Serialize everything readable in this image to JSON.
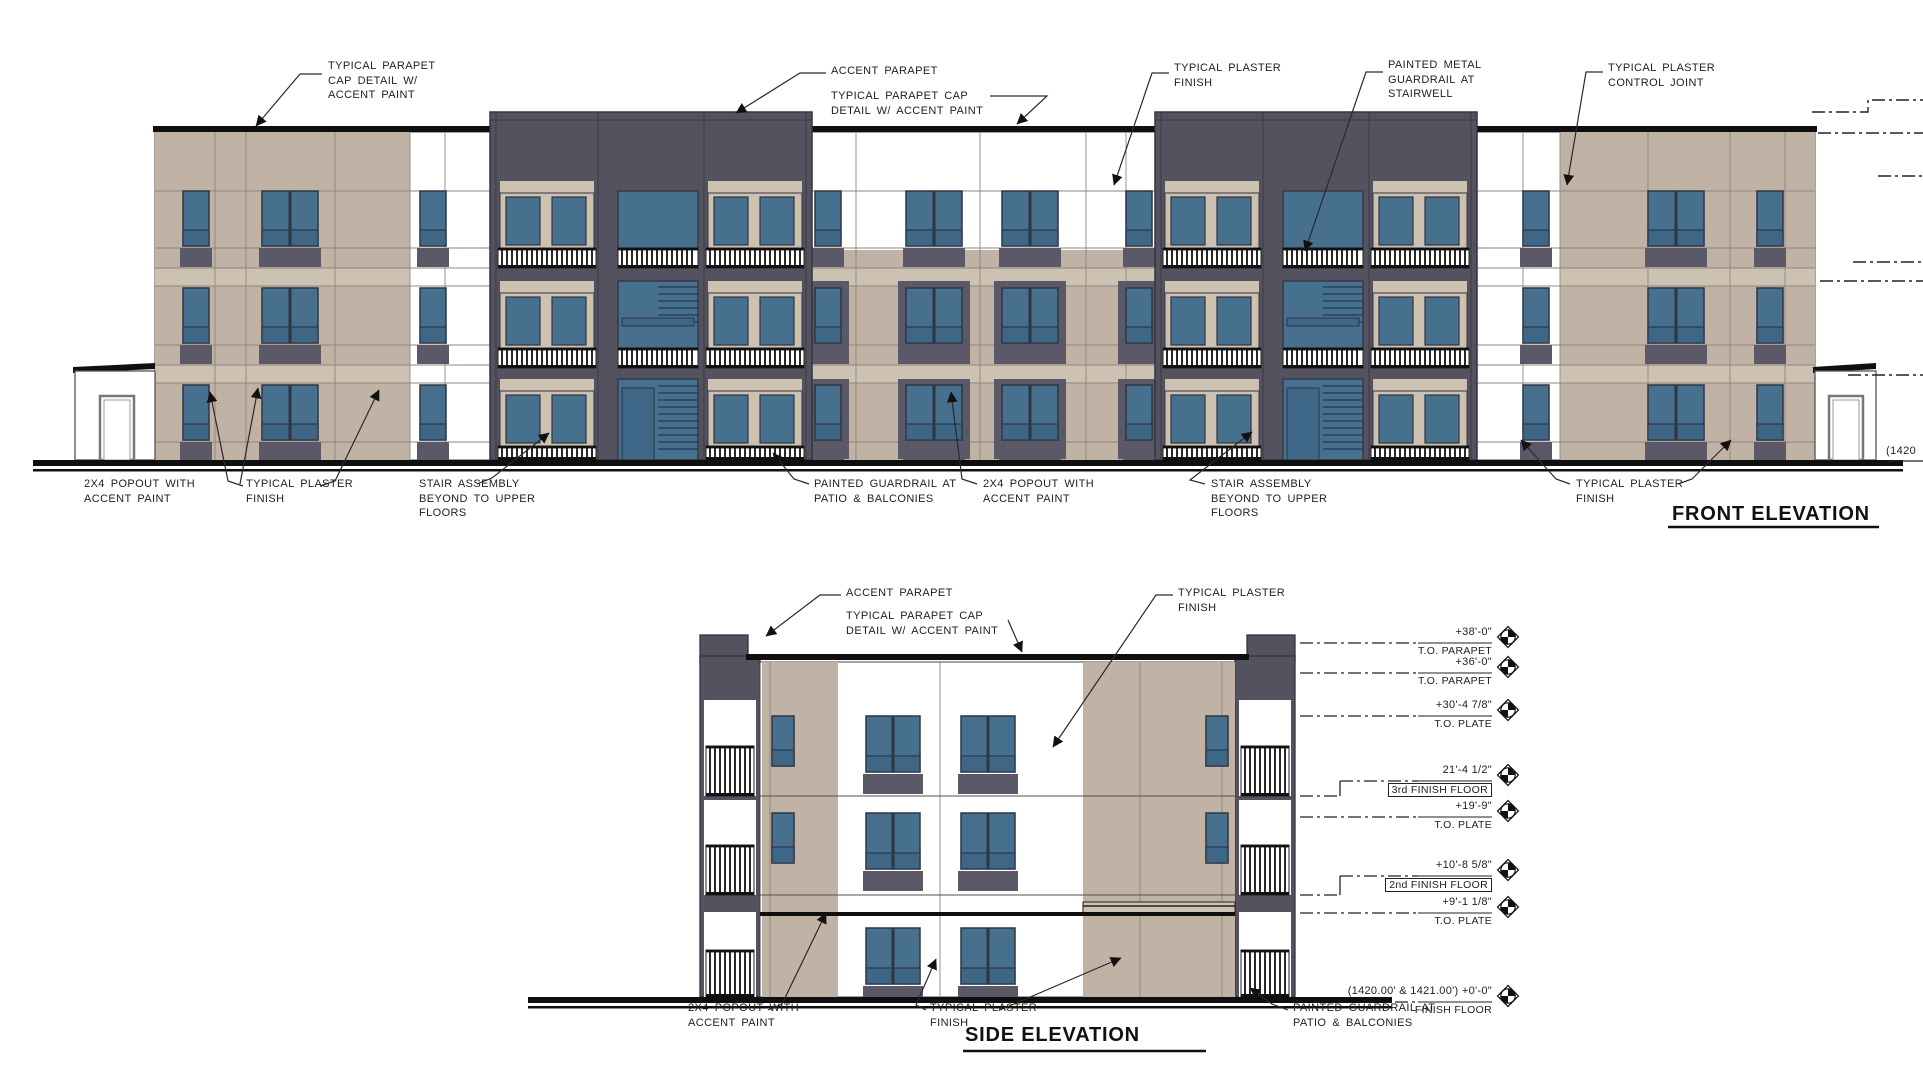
{
  "sheet": {
    "type_note": "architectural elevation drawing"
  },
  "front_elevation": {
    "title": "FRONT ELEVATION",
    "callouts": {
      "parapet_cap_left": "TYPICAL PARAPET\nCAP DETAIL W/\nACCENT PAINT",
      "accent_parapet": "ACCENT PARAPET",
      "parapet_cap_mid": "TYPICAL PARAPET CAP\nDETAIL W/ ACCENT PAINT",
      "plaster_finish_top": "TYPICAL PLASTER\nFINISH",
      "metal_guardrail": "PAINTED METAL\nGUARDRAIL AT\nSTAIRWELL",
      "control_joint": "TYPICAL PLASTER\nCONTROL JOINT",
      "popout_left": "2X4 POPOUT WITH\nACCENT PAINT",
      "plaster_finish_bottom_left": "TYPICAL PLASTER\nFINISH",
      "stair_assembly_left": "STAIR ASSEMBLY\nBEYOND TO UPPER\nFLOORS",
      "guardrail_patio": "PAINTED GUARDRAIL AT\nPATIO & BALCONIES",
      "popout_mid": "2X4 POPOUT WITH\nACCENT PAINT",
      "stair_assembly_right": "STAIR ASSEMBLY\nBEYOND TO UPPER\nFLOORS",
      "plaster_finish_bottom_right": "TYPICAL PLASTER\nFINISH",
      "partial_right_note": "(1420"
    }
  },
  "side_elevation": {
    "title": "SIDE ELEVATION",
    "callouts": {
      "accent_parapet": "ACCENT PARAPET",
      "parapet_cap": "TYPICAL PARAPET CAP\nDETAIL W/ ACCENT PAINT",
      "plaster_finish_top": "TYPICAL PLASTER\nFINISH",
      "popout": "2X4 POPOUT WITH\nACCENT PAINT",
      "plaster_finish_bottom": "TYPICAL PLASTER\nFINISH",
      "guardrail_patio": "PAINTED GUARDRAIL AT\nPATIO & BALCONIES"
    },
    "markers": [
      {
        "value": "+38'-0\"",
        "label": "T.O. PARAPET",
        "boxed": false
      },
      {
        "value": "+36'-0\"",
        "label": "T.O. PARAPET",
        "boxed": false
      },
      {
        "value": "+30'-4 7/8\"",
        "label": "T.O. PLATE",
        "boxed": false
      },
      {
        "value": "21'-4 1/2\"",
        "label": "3rd FINISH FLOOR",
        "boxed": true
      },
      {
        "value": "+19'-9\"",
        "label": "T.O. PLATE",
        "boxed": false
      },
      {
        "value": "+10'-8 5/8\"",
        "label": "2nd FINISH FLOOR",
        "boxed": true
      },
      {
        "value": "+9'-1 1/8\"",
        "label": "T.O. PLATE",
        "boxed": false
      },
      {
        "value": "(1420.00' & 1421.00') +0'-0\"",
        "label": "FINISH FLOOR",
        "boxed": false
      }
    ]
  },
  "colors": {
    "plaster_tan": "#c0b3a5",
    "plaster_tan_light": "#cdc1b2",
    "accent_charcoal": "#54525f",
    "window_blue": "#47708e",
    "window_blue_dark": "#3e6787",
    "spandrel_gray": "#5b5868",
    "rail_black": "#151515",
    "line_black": "#1c1c1c",
    "joint_gray": "#8d867c",
    "white": "#ffffff"
  }
}
